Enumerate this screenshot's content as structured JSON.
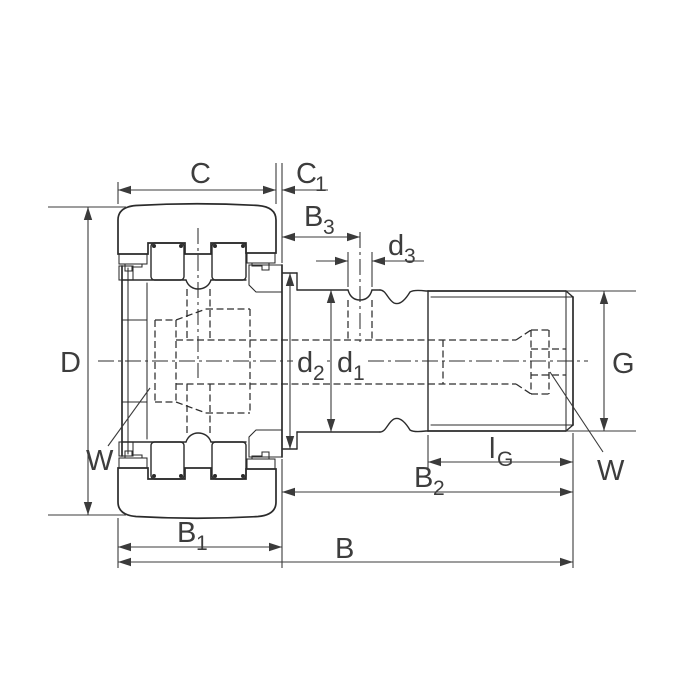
{
  "drawing": {
    "colors": {
      "background": "#ffffff",
      "part_line": "#2b2b2b",
      "dimension_line": "#3b3b3b",
      "label_text": "#3d3d3d"
    },
    "labels": {
      "C": {
        "base": "C",
        "sub": ""
      },
      "C1": {
        "base": "C",
        "sub": "1"
      },
      "B3": {
        "base": "B",
        "sub": "3"
      },
      "d3": {
        "base": "d",
        "sub": "3"
      },
      "D": {
        "base": "D",
        "sub": ""
      },
      "W_left": {
        "base": "W",
        "sub": ""
      },
      "d2": {
        "base": "d",
        "sub": "2"
      },
      "d1": {
        "base": "d",
        "sub": "1"
      },
      "G": {
        "base": "G",
        "sub": ""
      },
      "lG": {
        "base": "l",
        "sub": "G"
      },
      "B2": {
        "base": "B",
        "sub": "2"
      },
      "B1": {
        "base": "B",
        "sub": "1"
      },
      "B": {
        "base": "B",
        "sub": ""
      },
      "W_right": {
        "base": "W",
        "sub": ""
      }
    }
  }
}
